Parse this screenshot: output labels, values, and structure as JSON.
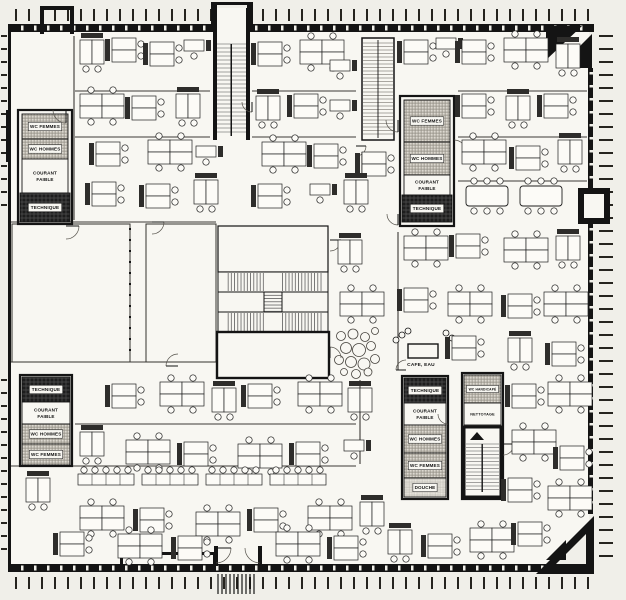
{
  "plan": {
    "type": "architectural-floor-plan",
    "palette": {
      "paper": "#f0efe9",
      "interior": "#f8f7f2",
      "ink": "#141414",
      "hatch_bg": "#dcd8cf",
      "hatch_line": "#8f8b82",
      "dark_fill": "#1d1d1d",
      "tread_line": "#4a4a4a"
    },
    "rooms": [
      {
        "id": "wc-femmes-top-left",
        "label": "WC FEMMES",
        "x": 22,
        "y": 114,
        "w": 46,
        "h": 25,
        "fill": "hatch"
      },
      {
        "id": "wc-hommes-top-left",
        "label": "WC HOMMES",
        "x": 22,
        "y": 139,
        "w": 46,
        "h": 20,
        "fill": "hatch"
      },
      {
        "id": "courant-faible-top-left",
        "label": "COURANT FAIBLE",
        "lines": [
          "COURANT",
          "FAIBLE"
        ],
        "x": 22,
        "y": 159,
        "w": 46,
        "h": 34,
        "fill": "white"
      },
      {
        "id": "technique-top-left",
        "label": "TECHNIQUE",
        "x": 20,
        "y": 193,
        "w": 50,
        "h": 29,
        "fill": "dark"
      },
      {
        "id": "wc-femmes-top-mid",
        "label": "WC FEMMES",
        "x": 404,
        "y": 100,
        "w": 46,
        "h": 42,
        "fill": "hatch"
      },
      {
        "id": "wc-hommes-top-mid",
        "label": "WC HOMMES",
        "x": 404,
        "y": 142,
        "w": 46,
        "h": 33,
        "fill": "hatch"
      },
      {
        "id": "courant-faible-top-mid",
        "label": "COURANT FAIBLE",
        "lines": [
          "COURANT",
          "FAIBLE"
        ],
        "x": 404,
        "y": 175,
        "w": 46,
        "h": 20,
        "fill": "white"
      },
      {
        "id": "technique-top-mid",
        "label": "TECHNIQUE",
        "x": 402,
        "y": 195,
        "w": 50,
        "h": 27,
        "fill": "dark"
      },
      {
        "id": "technique-bot-left",
        "label": "TECHNIQUE",
        "x": 22,
        "y": 377,
        "w": 48,
        "h": 25,
        "fill": "dark"
      },
      {
        "id": "courant-faible-bot-left",
        "label": "COURANT FAIBLE",
        "lines": [
          "COURANT",
          "FAIBLE"
        ],
        "x": 22,
        "y": 402,
        "w": 48,
        "h": 22,
        "fill": "white"
      },
      {
        "id": "wc-hommes-bot-left",
        "label": "WC HOMMES",
        "x": 22,
        "y": 424,
        "w": 48,
        "h": 20,
        "fill": "hatch"
      },
      {
        "id": "wc-femmes-bot-left",
        "label": "WC FEMMES",
        "x": 22,
        "y": 444,
        "w": 48,
        "h": 21,
        "fill": "hatch"
      },
      {
        "id": "technique-bot-mid",
        "label": "TECHNIQUE",
        "x": 404,
        "y": 378,
        "w": 42,
        "h": 25,
        "fill": "dark"
      },
      {
        "id": "courant-faible-bot-mid",
        "label": "COURANT FAIBLE",
        "lines": [
          "COURANT",
          "FAIBLE"
        ],
        "x": 404,
        "y": 403,
        "w": 42,
        "h": 22,
        "fill": "white"
      },
      {
        "id": "wc-hommes-bot-mid",
        "label": "WC HOMMES",
        "x": 404,
        "y": 425,
        "w": 42,
        "h": 28,
        "fill": "hatch"
      },
      {
        "id": "wc-femmes-bot-mid",
        "label": "WC FEMMES",
        "x": 404,
        "y": 453,
        "w": 42,
        "h": 25,
        "fill": "hatch"
      },
      {
        "id": "douche",
        "label": "DOUCHE",
        "x": 404,
        "y": 478,
        "w": 42,
        "h": 19,
        "fill": "lighthatch"
      },
      {
        "id": "wc-handicape",
        "label": "WC HANDICAPÉ",
        "x": 464,
        "y": 375,
        "w": 37,
        "h": 28,
        "fill": "hatch",
        "fs": 3.3
      },
      {
        "id": "nettoyage",
        "label": "NETTOYAGE",
        "x": 464,
        "y": 403,
        "w": 37,
        "h": 22,
        "fill": "white",
        "fs": 3.8
      }
    ],
    "core_outlines": [
      [
        18,
        110,
        54,
        114
      ],
      [
        400,
        96,
        54,
        130
      ],
      [
        20,
        375,
        52,
        91
      ],
      [
        402,
        376,
        46,
        123
      ],
      [
        462,
        373,
        41,
        126
      ]
    ],
    "cafe": {
      "label": "CAFE, EAU",
      "label_pos": [
        421,
        366
      ],
      "counter": [
        408,
        344,
        30,
        14
      ],
      "stools": [
        [
          396,
          340
        ],
        [
          402,
          335
        ],
        [
          408,
          331
        ],
        [
          446,
          333
        ],
        [
          452,
          338
        ],
        [
          458,
          343
        ]
      ],
      "lounge_circles": [
        [
          341,
          336,
          4.5
        ],
        [
          353,
          334,
          5
        ],
        [
          365,
          337,
          4.5
        ],
        [
          375,
          331,
          3.5
        ],
        [
          346,
          348,
          5.5
        ],
        [
          359,
          350,
          6.5
        ],
        [
          371,
          346,
          4.5
        ],
        [
          339,
          360,
          4.5
        ],
        [
          351,
          362,
          5.5
        ],
        [
          364,
          364,
          6
        ],
        [
          375,
          359,
          4.5
        ],
        [
          344,
          372,
          3.5
        ],
        [
          356,
          374,
          4.5
        ],
        [
          368,
          372,
          4
        ]
      ]
    },
    "empty_rooms": [
      [
        12,
        224,
        118,
        138
      ],
      [
        146,
        224,
        70,
        138
      ]
    ],
    "partitions": [
      [
        74,
        36,
        74,
        220
      ],
      [
        75,
        91,
        210,
        91
      ],
      [
        252,
        91,
        356,
        91
      ],
      [
        458,
        91,
        587,
        91
      ],
      [
        75,
        137,
        210,
        137
      ],
      [
        252,
        137,
        356,
        137
      ],
      [
        458,
        137,
        587,
        137
      ],
      [
        458,
        181,
        587,
        181
      ],
      [
        11,
        222,
        216,
        222
      ],
      [
        11,
        362,
        216,
        362
      ],
      [
        398,
        232,
        398,
        370
      ],
      [
        75,
        424,
        356,
        424
      ],
      [
        11,
        466,
        356,
        466
      ],
      [
        360,
        380,
        360,
        464
      ],
      [
        362,
        152,
        362,
        176
      ]
    ],
    "door_arcs": [
      [
        66,
        110,
        13,
        1
      ],
      [
        66,
        226,
        13,
        0
      ],
      [
        152,
        222,
        12,
        0
      ],
      [
        398,
        120,
        12,
        1
      ],
      [
        398,
        214,
        11,
        1
      ],
      [
        454,
        152,
        12,
        3
      ],
      [
        330,
        240,
        11,
        0
      ],
      [
        330,
        358,
        11,
        3
      ],
      [
        178,
        366,
        12,
        2
      ],
      [
        406,
        370,
        10,
        2
      ],
      [
        448,
        414,
        10,
        1
      ],
      [
        503,
        444,
        11,
        0
      ],
      [
        216,
        548,
        15,
        0
      ],
      [
        260,
        548,
        15,
        1
      ],
      [
        356,
        146,
        10,
        0
      ],
      [
        252,
        102,
        10,
        1
      ]
    ],
    "desk_clusters": [
      {
        "x": 80,
        "y": 40,
        "t": "duo-v"
      },
      {
        "x": 112,
        "y": 38,
        "t": "duo-h"
      },
      {
        "x": 150,
        "y": 42,
        "t": "duo-h"
      },
      {
        "x": 184,
        "y": 40,
        "t": "single"
      },
      {
        "x": 258,
        "y": 42,
        "t": "duo-h"
      },
      {
        "x": 300,
        "y": 40,
        "t": "quad"
      },
      {
        "x": 330,
        "y": 60,
        "t": "single"
      },
      {
        "x": 404,
        "y": 40,
        "t": "duo-h"
      },
      {
        "x": 436,
        "y": 38,
        "t": "single"
      },
      {
        "x": 462,
        "y": 40,
        "t": "duo-h"
      },
      {
        "x": 504,
        "y": 38,
        "t": "quad"
      },
      {
        "x": 556,
        "y": 44,
        "t": "duo-v"
      },
      {
        "x": 80,
        "y": 94,
        "t": "quad"
      },
      {
        "x": 132,
        "y": 96,
        "t": "duo-h"
      },
      {
        "x": 176,
        "y": 94,
        "t": "duo-v"
      },
      {
        "x": 256,
        "y": 96,
        "t": "duo-v"
      },
      {
        "x": 294,
        "y": 94,
        "t": "duo-h"
      },
      {
        "x": 330,
        "y": 100,
        "t": "single"
      },
      {
        "x": 462,
        "y": 94,
        "t": "duo-h"
      },
      {
        "x": 506,
        "y": 96,
        "t": "duo-v"
      },
      {
        "x": 544,
        "y": 94,
        "t": "duo-h"
      },
      {
        "x": 96,
        "y": 142,
        "t": "duo-h"
      },
      {
        "x": 148,
        "y": 140,
        "t": "quad"
      },
      {
        "x": 196,
        "y": 146,
        "t": "single"
      },
      {
        "x": 262,
        "y": 142,
        "t": "quad"
      },
      {
        "x": 314,
        "y": 144,
        "t": "duo-h"
      },
      {
        "x": 362,
        "y": 152,
        "t": "duo-h"
      },
      {
        "x": 462,
        "y": 140,
        "t": "quad"
      },
      {
        "x": 516,
        "y": 146,
        "t": "duo-h"
      },
      {
        "x": 558,
        "y": 140,
        "t": "duo-v"
      },
      {
        "x": 92,
        "y": 182,
        "t": "duo-h"
      },
      {
        "x": 146,
        "y": 184,
        "t": "duo-h"
      },
      {
        "x": 194,
        "y": 180,
        "t": "duo-v"
      },
      {
        "x": 258,
        "y": 184,
        "t": "duo-h"
      },
      {
        "x": 310,
        "y": 184,
        "t": "single"
      },
      {
        "x": 344,
        "y": 180,
        "t": "duo-v"
      },
      {
        "x": 466,
        "y": 186,
        "t": "conf6"
      },
      {
        "x": 520,
        "y": 186,
        "t": "conf6"
      },
      {
        "x": 338,
        "y": 240,
        "t": "duo-v"
      },
      {
        "x": 340,
        "y": 292,
        "t": "quad"
      },
      {
        "x": 404,
        "y": 236,
        "t": "quad"
      },
      {
        "x": 456,
        "y": 234,
        "t": "duo-h"
      },
      {
        "x": 504,
        "y": 238,
        "t": "quad"
      },
      {
        "x": 556,
        "y": 236,
        "t": "duo-v"
      },
      {
        "x": 404,
        "y": 288,
        "t": "duo-h"
      },
      {
        "x": 448,
        "y": 292,
        "t": "quad"
      },
      {
        "x": 508,
        "y": 294,
        "t": "duo-h"
      },
      {
        "x": 544,
        "y": 292,
        "t": "quad"
      },
      {
        "x": 452,
        "y": 336,
        "t": "duo-h"
      },
      {
        "x": 508,
        "y": 338,
        "t": "duo-v"
      },
      {
        "x": 552,
        "y": 342,
        "t": "duo-h"
      },
      {
        "x": 112,
        "y": 384,
        "t": "duo-h"
      },
      {
        "x": 160,
        "y": 382,
        "t": "quad"
      },
      {
        "x": 212,
        "y": 388,
        "t": "duo-v"
      },
      {
        "x": 248,
        "y": 384,
        "t": "duo-h"
      },
      {
        "x": 298,
        "y": 382,
        "t": "quad"
      },
      {
        "x": 348,
        "y": 388,
        "t": "duo-v"
      },
      {
        "x": 512,
        "y": 384,
        "t": "duo-h"
      },
      {
        "x": 548,
        "y": 382,
        "t": "quad"
      },
      {
        "x": 80,
        "y": 432,
        "t": "duo-v"
      },
      {
        "x": 126,
        "y": 440,
        "t": "quad"
      },
      {
        "x": 184,
        "y": 442,
        "t": "duo-h"
      },
      {
        "x": 238,
        "y": 444,
        "t": "quad"
      },
      {
        "x": 296,
        "y": 442,
        "t": "duo-h"
      },
      {
        "x": 344,
        "y": 440,
        "t": "single"
      },
      {
        "x": 512,
        "y": 430,
        "t": "quad"
      },
      {
        "x": 560,
        "y": 446,
        "t": "duo-h"
      },
      {
        "x": 78,
        "y": 474,
        "t": "row"
      },
      {
        "x": 142,
        "y": 474,
        "t": "row"
      },
      {
        "x": 206,
        "y": 474,
        "t": "row"
      },
      {
        "x": 270,
        "y": 474,
        "t": "row"
      },
      {
        "x": 26,
        "y": 478,
        "t": "duo-v"
      },
      {
        "x": 80,
        "y": 506,
        "t": "quad"
      },
      {
        "x": 140,
        "y": 508,
        "t": "duo-h"
      },
      {
        "x": 196,
        "y": 512,
        "t": "quad"
      },
      {
        "x": 254,
        "y": 508,
        "t": "duo-h"
      },
      {
        "x": 308,
        "y": 506,
        "t": "quad"
      },
      {
        "x": 360,
        "y": 502,
        "t": "duo-v"
      },
      {
        "x": 508,
        "y": 478,
        "t": "duo-h"
      },
      {
        "x": 548,
        "y": 486,
        "t": "quad"
      },
      {
        "x": 60,
        "y": 532,
        "t": "duo-h"
      },
      {
        "x": 118,
        "y": 534,
        "t": "quad"
      },
      {
        "x": 178,
        "y": 536,
        "t": "duo-h"
      },
      {
        "x": 276,
        "y": 532,
        "t": "quad"
      },
      {
        "x": 334,
        "y": 536,
        "t": "duo-h"
      },
      {
        "x": 388,
        "y": 530,
        "t": "duo-v"
      },
      {
        "x": 428,
        "y": 534,
        "t": "duo-h"
      },
      {
        "x": 470,
        "y": 528,
        "t": "quad"
      },
      {
        "x": 518,
        "y": 522,
        "t": "duo-h"
      }
    ],
    "ticks": {
      "step": 13
    }
  }
}
